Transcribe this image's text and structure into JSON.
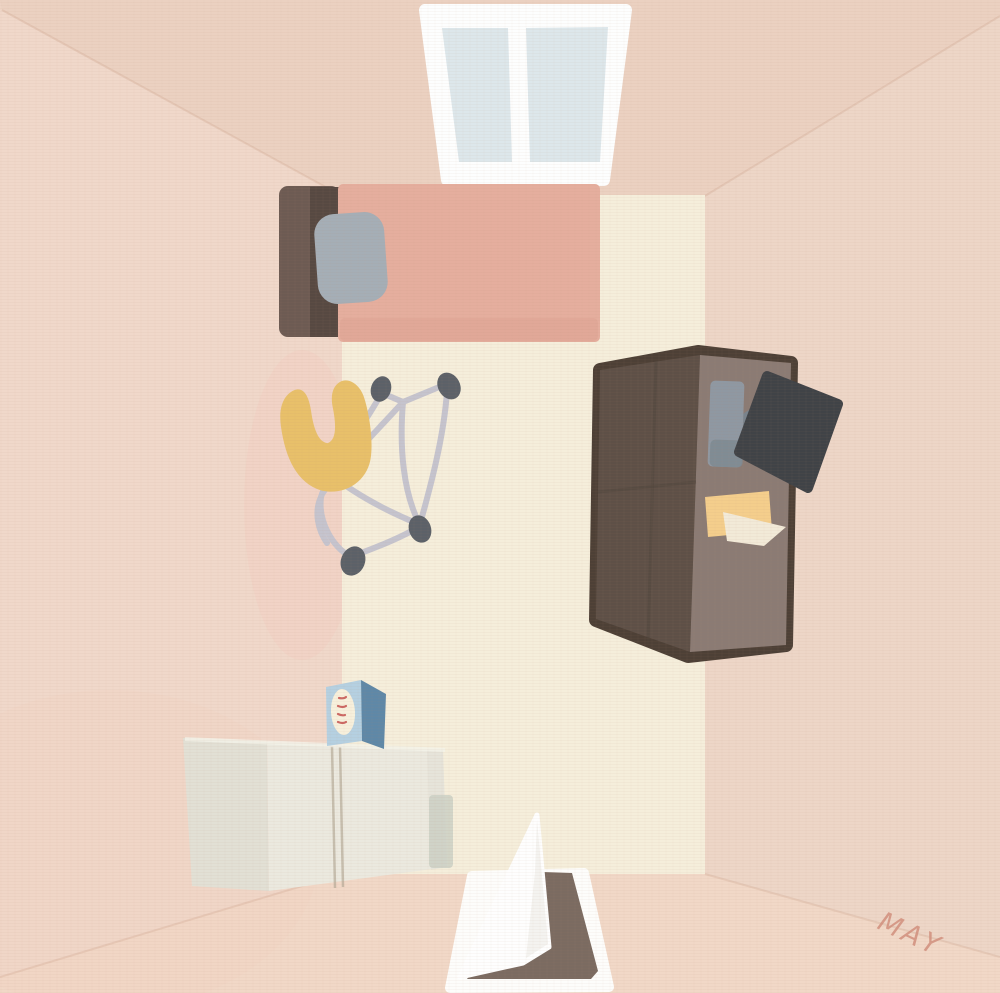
{
  "scene": {
    "name": "top-down-room-illustration"
  },
  "signature": {
    "text": "MAY",
    "color": "#d2907e"
  },
  "palette": {
    "wall_base": "#eed5c6",
    "wall_top": "#ebd1c1",
    "wall_left": "#f0d8ca",
    "wall_right": "#edd6c7",
    "wall_bottom": "#f1d8c7",
    "wall_blush": "#f2cfc0",
    "fold_line": "#c89b82",
    "floor": "#f5eedb",
    "window_frame": "#fdfefe",
    "window_pane": "#dde7eb",
    "bed_frame": "#6d5b53",
    "bed_frame_dark": "#574942",
    "blanket": "#e5ae9e",
    "blanket_shade": "#dca190",
    "pillow": "#a5aeb6",
    "stroller_frame": "#c5c4ce",
    "stroller_wheel": "#5c6168",
    "neck_pillow": "#e8c06a",
    "wardrobe_outline": "#4d4036",
    "wardrobe_dark": "#5e5047",
    "wardrobe_light": "#8b7b74",
    "wardrobe_seam": "#50443c",
    "chair": "#404347",
    "laptop": "#8f98a2",
    "laptop_dark": "#7e8992",
    "monitor_arm": "#79838c",
    "note_yellow": "#f4ce8c",
    "paper_white": "#f2ead8",
    "dresser_front": "#ebe9df",
    "dresser_side": "#e2e0d5",
    "dresser_seam": "#b7ab99",
    "dresser_highlight": "#f4f2e9",
    "box_front": "#b5d0e1",
    "box_side": "#5f88a7",
    "box_label": "#f7f0dc",
    "box_label_text": "#c4504e",
    "door_leaf": "#fefefe",
    "door_frame": "#fdfdfb",
    "door_leaf_shade": "#e9e7e1",
    "doorway": "#7b6b61",
    "floor_mat_shadow": "#cbd0c4"
  }
}
